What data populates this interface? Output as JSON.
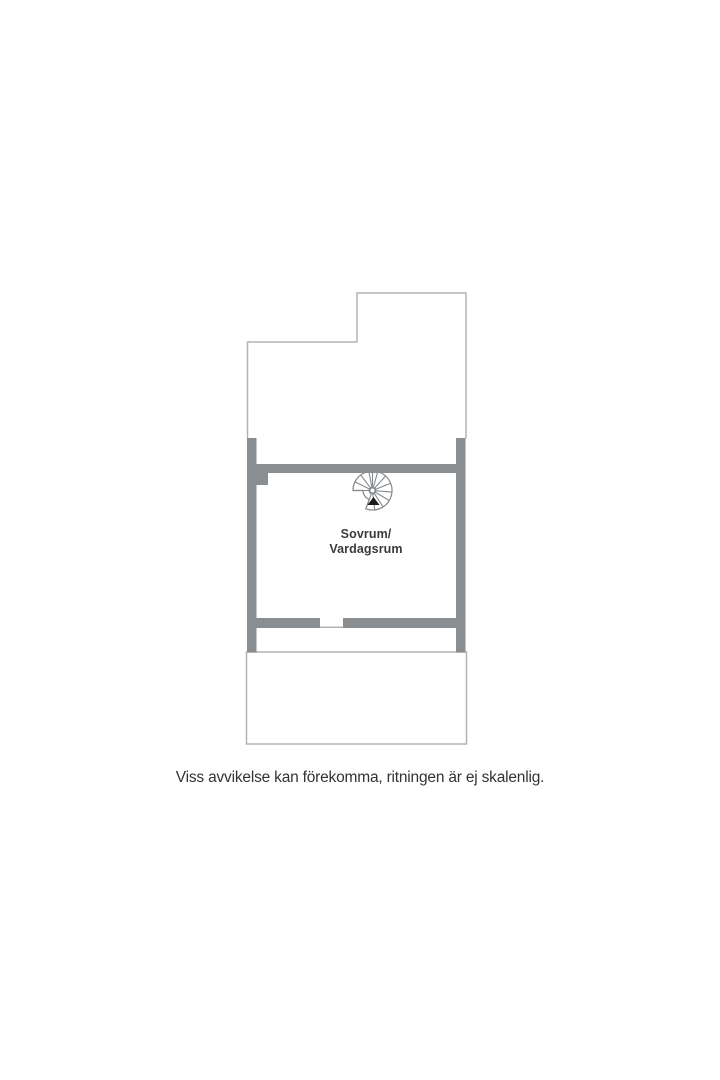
{
  "floor_plan": {
    "room_label": {
      "line1": "Sovrum/",
      "line2": "Vardagsrum"
    },
    "stair_icon": "spiral-staircase-icon",
    "disclaimer": "Viss avvikelse kan förekomma, ritningen är ej skalenlig."
  },
  "colors": {
    "wall": "#8a8e91",
    "outline": "#b3b3b3",
    "icon-line": "#85898c",
    "arrow": "#1c1c1c",
    "label-text": "#3b3b3b",
    "disclaimer-text": "#333333"
  }
}
